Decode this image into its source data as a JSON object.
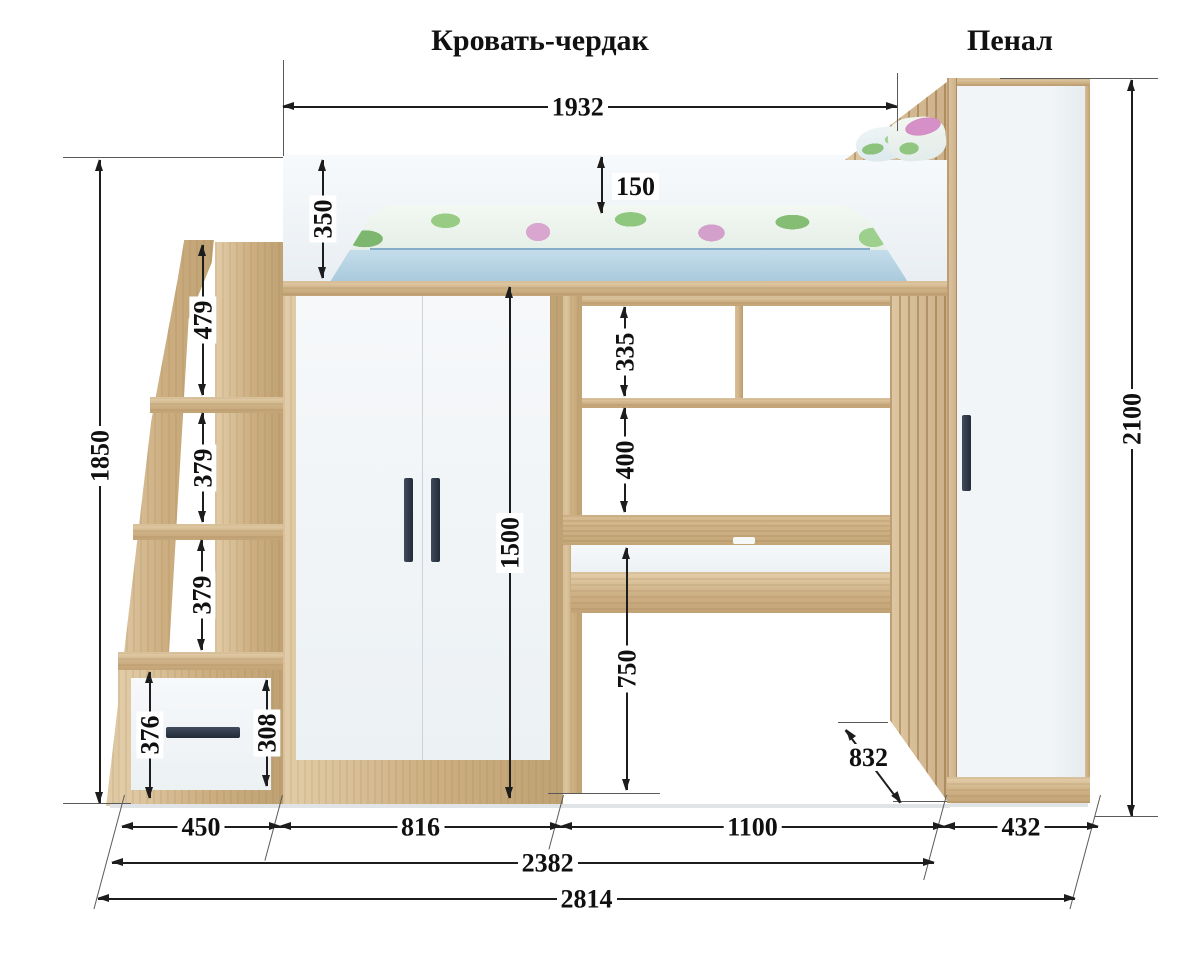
{
  "titles": {
    "bed": "Кровать-чердак",
    "cabinet": "Пенал"
  },
  "dims": {
    "bed_width": "1932",
    "mattress_above_rail": "150",
    "rail_height": "350",
    "ladder_total_height": "1850",
    "ladder_top_step": "479",
    "ladder_step_2": "379",
    "ladder_step_3": "379",
    "drawer_box_height": "376",
    "drawer_front_height": "308",
    "wardrobe_door_height": "1500",
    "hutch_cubby_height": "335",
    "shelf_to_desktop": "400",
    "desk_clearance": "750",
    "desk_depth": "832",
    "cabinet_height": "2100",
    "ladder_width": "450",
    "wardrobe_width": "816",
    "desk_width": "1100",
    "cabinet_width": "432",
    "combined_width": "2382",
    "overall_width": "2814"
  }
}
